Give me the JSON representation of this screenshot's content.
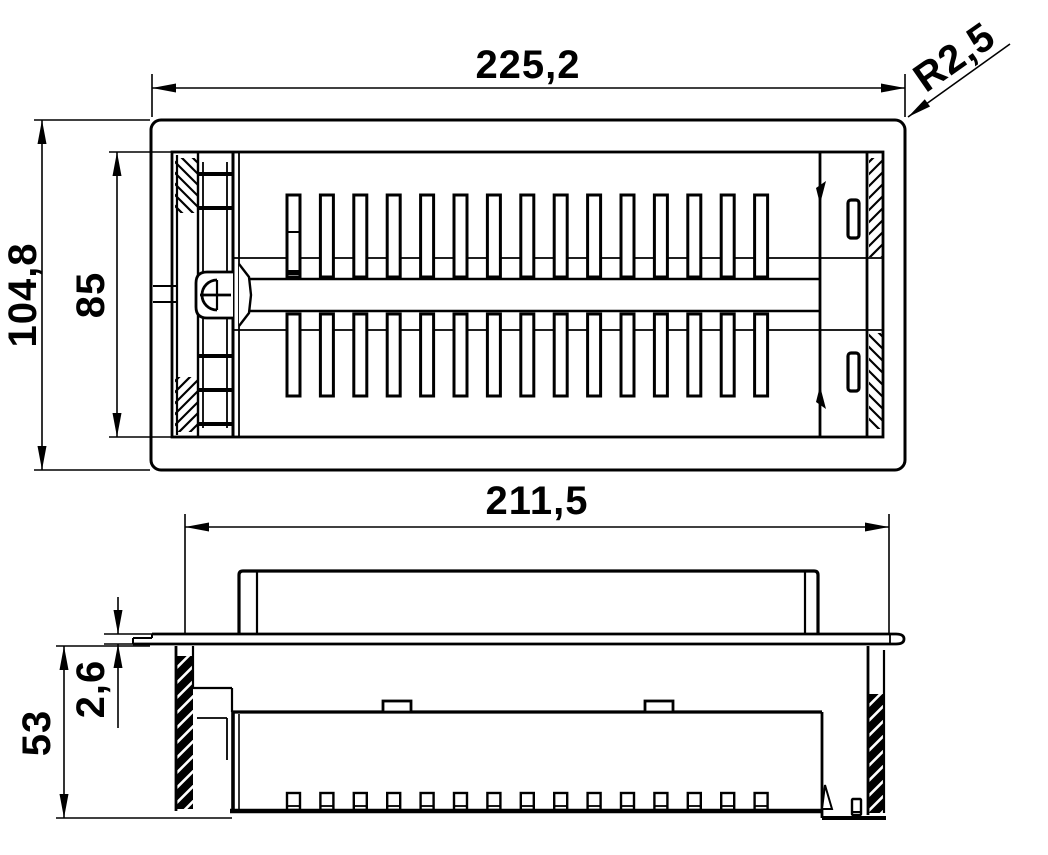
{
  "page": {
    "background": "#ffffff",
    "line_color": "#000000"
  },
  "drawing": {
    "type": "technical-drawing-2-views",
    "top_view": {
      "id": "top-view",
      "louver_rows": 2,
      "louver_slots_per_row": 15,
      "side_latch_slots": 2
    },
    "front_view": {
      "id": "front-view",
      "bottom_tabs": 15,
      "serrated_clips": 2
    },
    "dimensions": {
      "overall_width": {
        "label": "225,2"
      },
      "corner_radius": {
        "label": "R2,5"
      },
      "overall_height": {
        "label": "104,8"
      },
      "cutout_height": {
        "label": "85"
      },
      "insert_width": {
        "label": "211,5"
      },
      "insert_depth": {
        "label": "53"
      },
      "flange_thickness": {
        "label": "2,6"
      }
    }
  }
}
